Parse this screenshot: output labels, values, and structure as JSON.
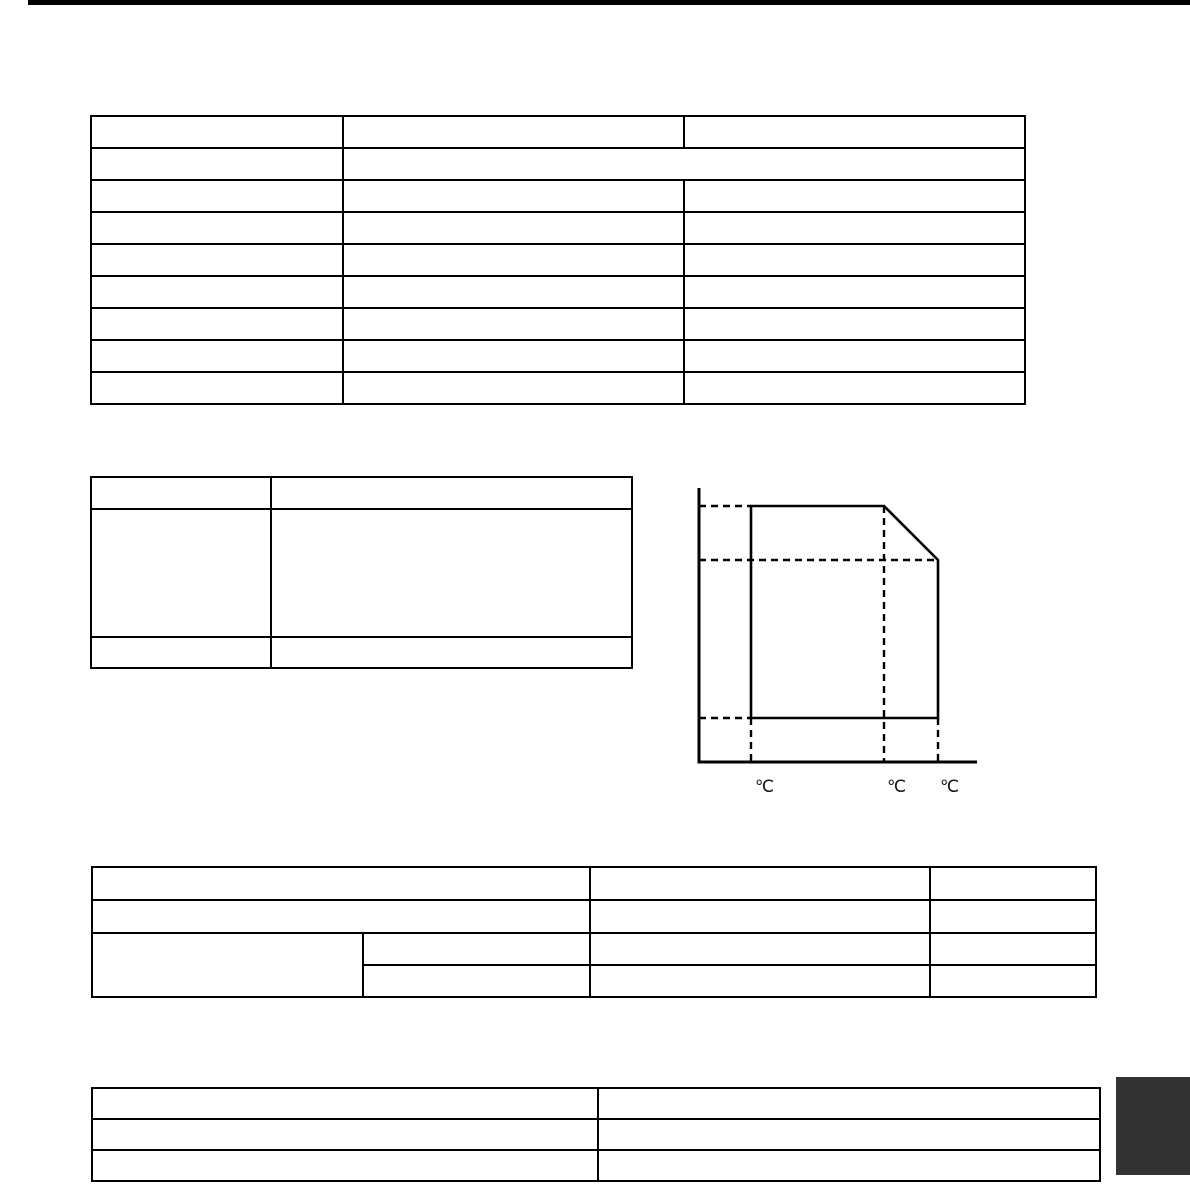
{
  "page": {
    "background_color": "#ffffff",
    "top_rule_color": "#000000",
    "table_border_color": "#000000",
    "corner_block_color": "#333333"
  },
  "table1": {
    "rows": [
      [
        "",
        "",
        ""
      ],
      [
        "",
        ""
      ],
      [
        "",
        "",
        ""
      ],
      [
        "",
        "",
        ""
      ],
      [
        "",
        "",
        ""
      ],
      [
        "",
        "",
        ""
      ],
      [
        "",
        "",
        ""
      ],
      [
        "",
        "",
        ""
      ],
      [
        "",
        "",
        ""
      ]
    ]
  },
  "table2": {
    "rows": [
      [
        "",
        ""
      ],
      [
        "",
        ""
      ],
      [
        "",
        ""
      ]
    ]
  },
  "diagram": {
    "type": "operating-range-envelope",
    "axes": "unlabeled x and y axes, dashed reference lines to envelope corners",
    "unit_labels": [
      "℃",
      "℃",
      "℃"
    ]
  },
  "table3": {
    "rows": [
      [
        "",
        "",
        ""
      ],
      [
        "",
        "",
        ""
      ],
      [
        "",
        "",
        "",
        ""
      ],
      [
        "",
        "",
        ""
      ]
    ]
  },
  "table4": {
    "rows": [
      [
        "",
        ""
      ],
      [
        "",
        ""
      ],
      [
        "",
        ""
      ]
    ]
  }
}
